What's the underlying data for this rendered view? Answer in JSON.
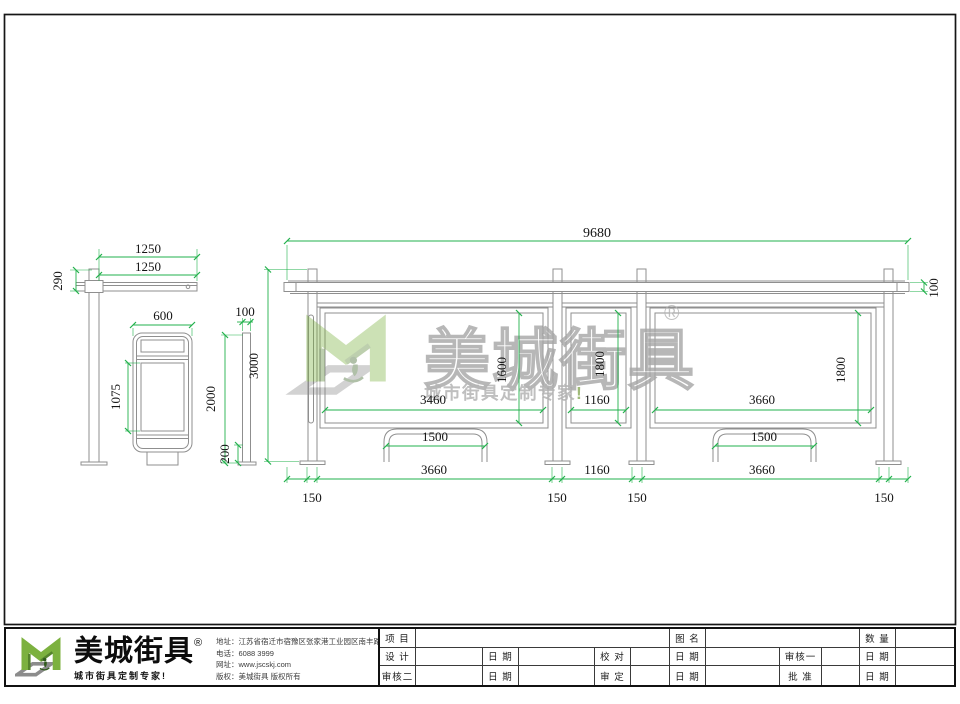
{
  "page": {
    "background": "#ffffff",
    "border_color": "#111111",
    "dimension_color": "#22b14c",
    "geometry_color": "#8f8f8f"
  },
  "dims": {
    "side_roof_top": "1250",
    "side_roof": "1250",
    "side_roof_h": "290",
    "side_box_w": "600",
    "side_box_h": "1075",
    "post_w": "100",
    "post_h": "2000",
    "post_base": "200",
    "post_total": "3000",
    "total_w": "9680",
    "roof_t": "100",
    "lp_w": "3460",
    "lp_h": "1600",
    "mp_w": "1160",
    "mp_h": "1800",
    "rp_w": "3660",
    "rp_h": "1800",
    "bench": "1500",
    "bot_l": "3660",
    "bot_m": "1160",
    "bot_r": "3660",
    "offset": "150"
  },
  "watermark": {
    "brand": "美城街具",
    "registered": "®",
    "tagline": "城市街具定制专家",
    "tagline_mark": "!"
  },
  "footer": {
    "brand": "美城街具",
    "registered": "®",
    "slogan": "城市街具定制专家!",
    "contact": {
      "address_label": "地址：",
      "address": "江苏省宿迁市宿豫区张家港工业园区南丰路西侧1号",
      "phone_label": "电话：",
      "phone": "6088 3999",
      "site_label": "网址：",
      "site": "www.jscskj.com",
      "copyright_label": "版权：",
      "copyright": "美城街具 版权所有"
    },
    "table": {
      "project": "项 目",
      "drawing_name": "图 名",
      "quantity": "数 量",
      "design": "设 计",
      "date": "日 期",
      "proofread": "校 对",
      "review1": "审核一",
      "review2": "审核二",
      "approve": "审 定",
      "ratify": "批 准"
    }
  }
}
